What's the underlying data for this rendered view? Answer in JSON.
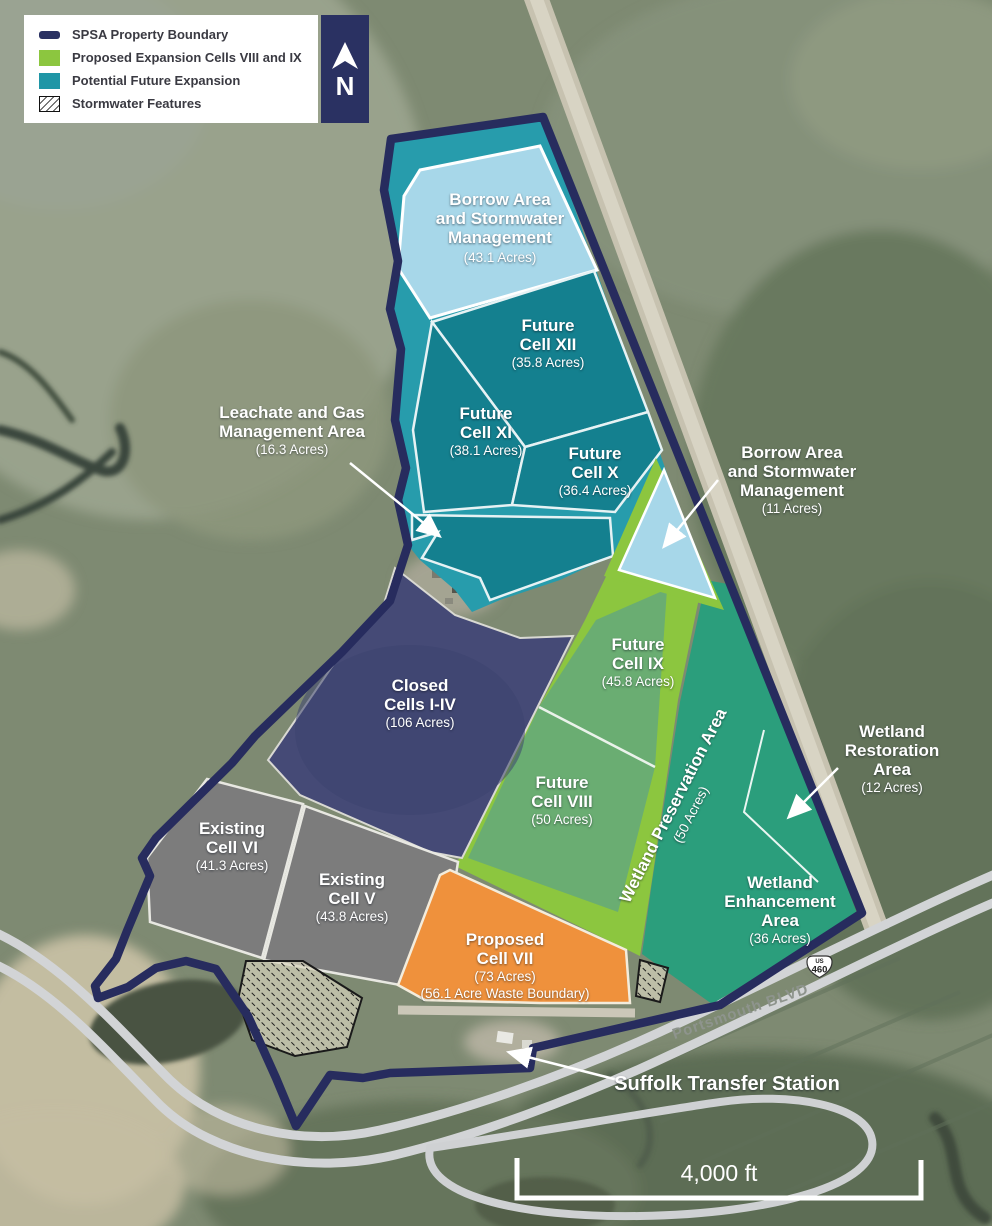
{
  "legend": {
    "items": [
      {
        "label": "SPSA Property Boundary",
        "swatch": "boundary"
      },
      {
        "label": "Proposed Expansion Cells VIII and IX",
        "swatch": "proposed"
      },
      {
        "label": "Potential Future Expansion",
        "swatch": "potential"
      },
      {
        "label": "Stormwater Features",
        "swatch": "stormwater"
      }
    ]
  },
  "north": {
    "label": "N"
  },
  "areas": {
    "borrow43": {
      "lines": [
        "Borrow Area",
        "and Stormwater",
        "Management"
      ],
      "acres": "(43.1 Acres)"
    },
    "cell12": {
      "lines": [
        "Future",
        "Cell XII"
      ],
      "acres": "(35.8 Acres)"
    },
    "cell11": {
      "lines": [
        "Future",
        "Cell XI"
      ],
      "acres": "(38.1 Acres)"
    },
    "cell10": {
      "lines": [
        "Future",
        "Cell X"
      ],
      "acres": "(36.4 Acres)"
    },
    "leachate": {
      "lines": [
        "Leachate and Gas",
        "Management Area"
      ],
      "acres": "(16.3 Acres)"
    },
    "borrow11": {
      "lines": [
        "Borrow Area",
        "and Stormwater",
        "Management"
      ],
      "acres": "(11 Acres)"
    },
    "closed": {
      "lines": [
        "Closed",
        "Cells I-IV"
      ],
      "acres": "(106 Acres)"
    },
    "cell9": {
      "lines": [
        "Future",
        "Cell IX"
      ],
      "acres": "(45.8 Acres)"
    },
    "cell8": {
      "lines": [
        "Future",
        "Cell VIII"
      ],
      "acres": "(50 Acres)"
    },
    "preservation": {
      "lines": [
        "Wetland Preservation Area"
      ],
      "acres": "(50 Acres)"
    },
    "restoration": {
      "lines": [
        "Wetland",
        "Restoration",
        "Area"
      ],
      "acres": "(12 Acres)"
    },
    "enhancement": {
      "lines": [
        "Wetland",
        "Enhancement",
        "Area"
      ],
      "acres": "(36 Acres)"
    },
    "cell6": {
      "lines": [
        "Existing",
        "Cell VI"
      ],
      "acres": "(41.3 Acres)"
    },
    "cell5": {
      "lines": [
        "Existing",
        "Cell V"
      ],
      "acres": "(43.8 Acres)"
    },
    "cell7": {
      "lines": [
        "Proposed",
        "Cell VII"
      ],
      "acres": "(73 Acres)",
      "acres2": "(56.1 Acre Waste Boundary)"
    }
  },
  "annotations": {
    "transfer_station": "Suffolk Transfer Station",
    "road_label": "Portsmouth BLVD",
    "route_us": "US",
    "route_number": "460",
    "scale_label": "4,000 ft"
  },
  "colors": {
    "boundary": "#272C5E",
    "potential_future": "#279CAC",
    "future_cell": "#14808F",
    "borrow_blue": "#A7D7E9",
    "proposed_green": "#8CC63F",
    "cell_fill_green": "#6AAD72",
    "wetland_green": "#2B9E7C",
    "existing_gray": "#7C7C7C",
    "closed_navy": "#454A76",
    "proposed_orange": "#EF913C"
  }
}
